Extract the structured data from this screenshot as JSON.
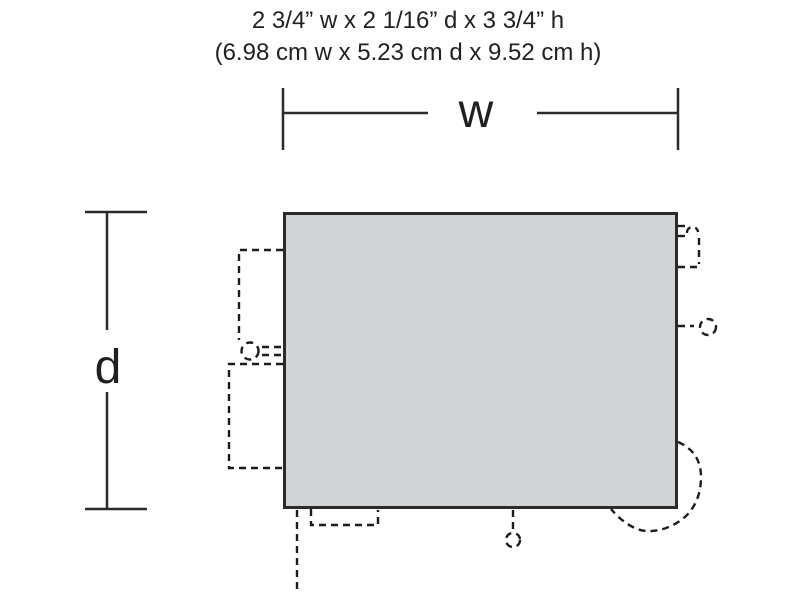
{
  "title": {
    "line_imperial": "2 3/4” w x 2 1/16” d x 3 3/4” h",
    "line_metric": "(6.98 cm w x 5.23 cm d x 9.52 cm h)"
  },
  "dimension_labels": {
    "width": "w",
    "depth": "d"
  },
  "colors": {
    "background": "#ffffff",
    "text": "#231f20",
    "dimension_line": "#2b2b2b",
    "detail_dash": "#1c1c1c",
    "footprint_fill": "#d2d3d4",
    "footprint_border": "#2b2b2b"
  }
}
